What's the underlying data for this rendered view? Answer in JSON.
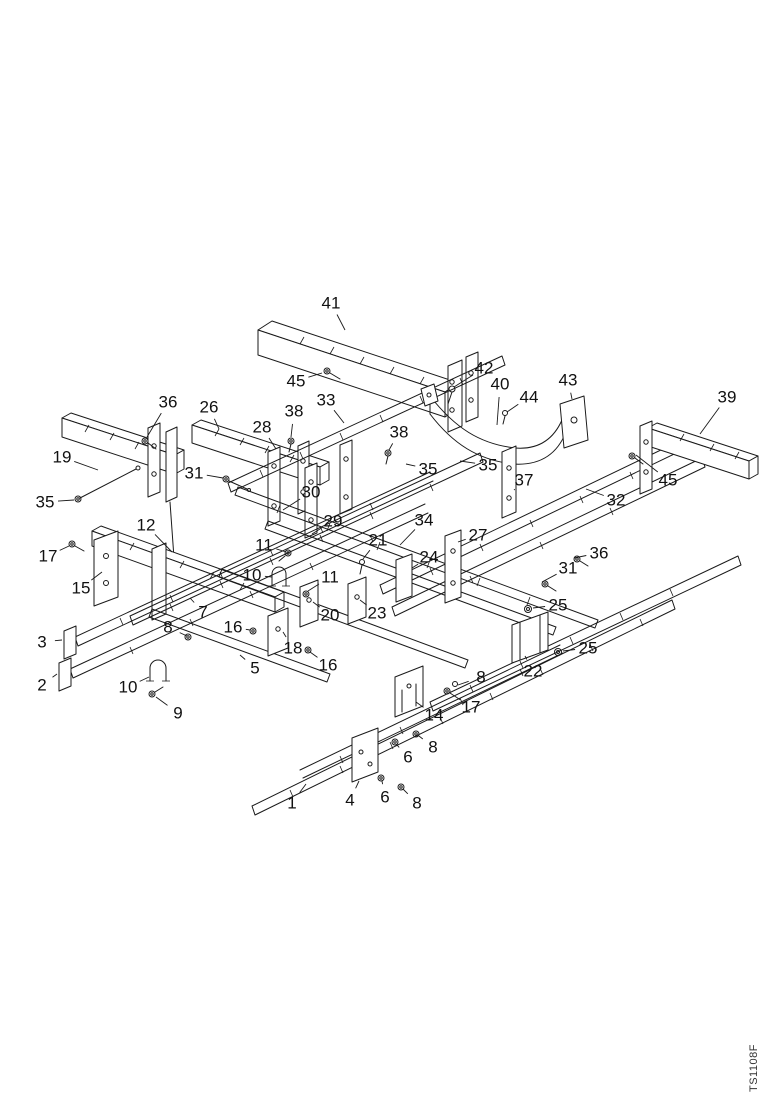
{
  "page": {
    "background": "#ffffff",
    "ink_color": "#1a1a1a",
    "watermark": "TS1108F"
  },
  "figure": {
    "type": "exploded-parts-diagram",
    "description": "Isometric exploded view of a frame assembly with numbered part callouts",
    "callouts": [
      {
        "label": "41",
        "x": 331,
        "y": 303,
        "tx": 345,
        "ty": 330
      },
      {
        "label": "45",
        "x": 296,
        "y": 381,
        "tx": 322,
        "ty": 373
      },
      {
        "label": "36",
        "x": 168,
        "y": 402,
        "tx": 147,
        "ty": 437
      },
      {
        "label": "26",
        "x": 209,
        "y": 407,
        "tx": 219,
        "ty": 429
      },
      {
        "label": "38",
        "x": 294,
        "y": 411,
        "tx": 291,
        "ty": 437
      },
      {
        "label": "28",
        "x": 262,
        "y": 427,
        "tx": 276,
        "ty": 449
      },
      {
        "label": "33",
        "x": 326,
        "y": 400,
        "tx": 344,
        "ty": 423
      },
      {
        "label": "42",
        "x": 484,
        "y": 368,
        "tx": 454,
        "ty": 387
      },
      {
        "label": "40",
        "x": 500,
        "y": 384,
        "tx": 497,
        "ty": 425
      },
      {
        "label": "44",
        "x": 529,
        "y": 397,
        "tx": 507,
        "ty": 412
      },
      {
        "label": "43",
        "x": 568,
        "y": 380,
        "tx": 572,
        "ty": 399
      },
      {
        "label": "39",
        "x": 727,
        "y": 397,
        "tx": 700,
        "ty": 434
      },
      {
        "label": "45",
        "x": 668,
        "y": 480,
        "tx": 636,
        "ty": 455
      },
      {
        "label": "35",
        "x": 428,
        "y": 469,
        "tx": 406,
        "ty": 464
      },
      {
        "label": "35",
        "x": 488,
        "y": 465,
        "tx": 460,
        "ty": 461
      },
      {
        "label": "38",
        "x": 399,
        "y": 432,
        "tx": 389,
        "ty": 450
      },
      {
        "label": "37",
        "x": 524,
        "y": 480,
        "tx": 514,
        "ty": 490
      },
      {
        "label": "32",
        "x": 616,
        "y": 500,
        "tx": 586,
        "ty": 489
      },
      {
        "label": "36",
        "x": 599,
        "y": 553,
        "tx": 574,
        "ty": 558
      },
      {
        "label": "31",
        "x": 568,
        "y": 568,
        "tx": 542,
        "ty": 582
      },
      {
        "label": "25",
        "x": 558,
        "y": 605,
        "tx": 533,
        "ty": 608
      },
      {
        "label": "25",
        "x": 588,
        "y": 648,
        "tx": 563,
        "ty": 651
      },
      {
        "label": "22",
        "x": 533,
        "y": 671,
        "tx": 525,
        "ty": 656
      },
      {
        "label": "19",
        "x": 62,
        "y": 457,
        "tx": 98,
        "ty": 470
      },
      {
        "label": "31",
        "x": 194,
        "y": 473,
        "tx": 223,
        "ty": 478
      },
      {
        "label": "35",
        "x": 45,
        "y": 502,
        "tx": 74,
        "ty": 500
      },
      {
        "label": "12",
        "x": 146,
        "y": 525,
        "tx": 172,
        "ty": 552
      },
      {
        "label": "17",
        "x": 48,
        "y": 556,
        "tx": 69,
        "ty": 546
      },
      {
        "label": "15",
        "x": 81,
        "y": 588,
        "tx": 102,
        "ty": 572
      },
      {
        "label": "3",
        "x": 42,
        "y": 642,
        "tx": 62,
        "ty": 640
      },
      {
        "label": "2",
        "x": 42,
        "y": 685,
        "tx": 57,
        "ty": 674
      },
      {
        "label": "30",
        "x": 311,
        "y": 492,
        "tx": 283,
        "ty": 510
      },
      {
        "label": "29",
        "x": 333,
        "y": 521,
        "tx": 312,
        "ty": 534
      },
      {
        "label": "34",
        "x": 424,
        "y": 520,
        "tx": 400,
        "ty": 545
      },
      {
        "label": "21",
        "x": 378,
        "y": 540,
        "tx": 363,
        "ty": 559
      },
      {
        "label": "24",
        "x": 429,
        "y": 557,
        "tx": 412,
        "ty": 568
      },
      {
        "label": "27",
        "x": 478,
        "y": 535,
        "tx": 458,
        "ty": 542
      },
      {
        "label": "11",
        "x": 264,
        "y": 545,
        "tx": 286,
        "ty": 552
      },
      {
        "label": "10",
        "x": 252,
        "y": 575,
        "tx": 272,
        "ty": 577
      },
      {
        "label": "11",
        "x": 330,
        "y": 577,
        "tx": 308,
        "ty": 591
      },
      {
        "label": "20",
        "x": 330,
        "y": 615,
        "tx": 313,
        "ty": 602
      },
      {
        "label": "23",
        "x": 377,
        "y": 613,
        "tx": 360,
        "ty": 600
      },
      {
        "label": "7",
        "x": 203,
        "y": 612,
        "tx": 190,
        "ty": 598
      },
      {
        "label": "8",
        "x": 168,
        "y": 627,
        "tx": 187,
        "ty": 636
      },
      {
        "label": "16",
        "x": 233,
        "y": 627,
        "tx": 250,
        "ty": 630
      },
      {
        "label": "18",
        "x": 293,
        "y": 648,
        "tx": 283,
        "ty": 632
      },
      {
        "label": "16",
        "x": 328,
        "y": 665,
        "tx": 310,
        "ty": 652
      },
      {
        "label": "5",
        "x": 255,
        "y": 668,
        "tx": 240,
        "ty": 655
      },
      {
        "label": "10",
        "x": 128,
        "y": 687,
        "tx": 149,
        "ty": 677
      },
      {
        "label": "9",
        "x": 178,
        "y": 713,
        "tx": 156,
        "ty": 697
      },
      {
        "label": "1",
        "x": 292,
        "y": 803,
        "tx": 306,
        "ty": 784
      },
      {
        "label": "4",
        "x": 350,
        "y": 800,
        "tx": 359,
        "ty": 781
      },
      {
        "label": "6",
        "x": 385,
        "y": 797,
        "tx": 382,
        "ty": 781
      },
      {
        "label": "8",
        "x": 417,
        "y": 803,
        "tx": 403,
        "ty": 789
      },
      {
        "label": "6",
        "x": 408,
        "y": 757,
        "tx": 397,
        "ty": 745
      },
      {
        "label": "8",
        "x": 433,
        "y": 747,
        "tx": 419,
        "ty": 736
      },
      {
        "label": "14",
        "x": 434,
        "y": 715,
        "tx": 416,
        "ty": 702
      },
      {
        "label": "17",
        "x": 471,
        "y": 707,
        "tx": 450,
        "ty": 693
      },
      {
        "label": "8",
        "x": 481,
        "y": 677,
        "tx": 458,
        "ty": 685
      }
    ]
  }
}
